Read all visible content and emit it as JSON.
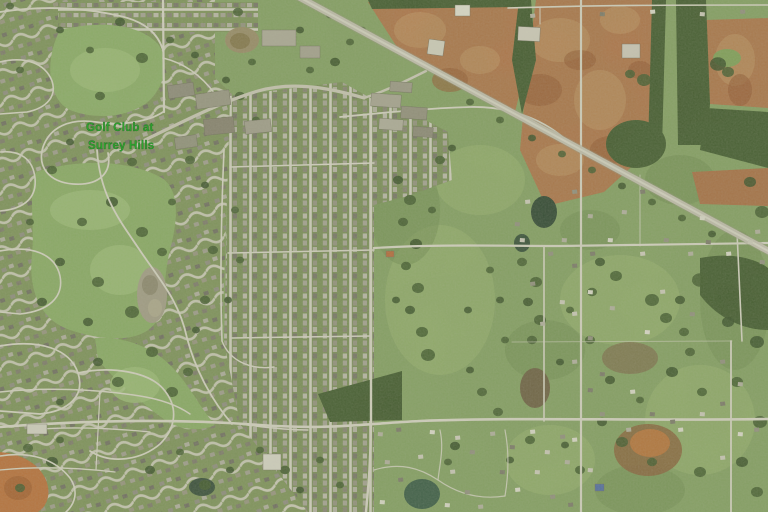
{
  "map": {
    "view_type": "satellite-aerial-imagery",
    "label": {
      "line1": "Golf Club at",
      "line2": "Surrey Hills",
      "color": "#2fa32f"
    },
    "palette": {
      "field_green": "#84a061",
      "suburb_green": "#7d9157",
      "fairway_green": "#8aac63",
      "tree_green": "#3a5226",
      "dirt_brown": "#b07044",
      "dirt_light": "#c18a59",
      "dirt_dark": "#96522c",
      "orange_dirt": "#bf6a33",
      "road_light": "#dcd7ca",
      "highway_gray": "#c7c1b3",
      "pond_dark": "#2e4433",
      "pond_brown": "#6b5a3e",
      "sand_tan": "#a59c88"
    }
  }
}
